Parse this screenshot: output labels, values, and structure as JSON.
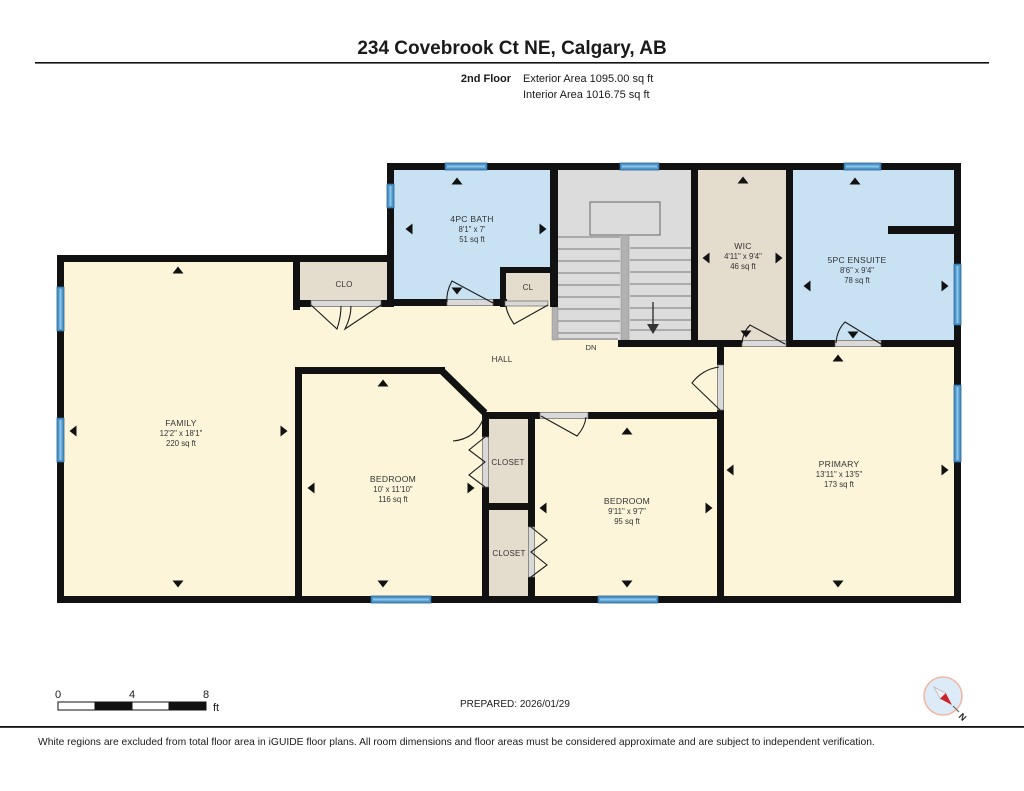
{
  "header": {
    "title": "234 Covebrook Ct NE, Calgary, AB",
    "floor_label": "2nd Floor",
    "exterior_area": "Exterior Area 1095.00 sq ft",
    "interior_area": "Interior Area 1016.75 sq ft"
  },
  "rooms": {
    "bath": {
      "name": "4PC BATH",
      "dims": "8'1\" x 7'",
      "area": "51 sq ft"
    },
    "wic": {
      "name": "WIC",
      "dims": "4'11\" x 9'4\"",
      "area": "46 sq ft"
    },
    "ensuite": {
      "name": "5PC ENSUITE",
      "dims": "8'6\" x 9'4\"",
      "area": "78 sq ft"
    },
    "family": {
      "name": "FAMILY",
      "dims": "12'2\" x 18'1\"",
      "area": "220 sq ft"
    },
    "bedroom1": {
      "name": "BEDROOM",
      "dims": "10' x 11'10\"",
      "area": "116 sq ft"
    },
    "bedroom2": {
      "name": "BEDROOM",
      "dims": "9'11\" x 9'7\"",
      "area": "95 sq ft"
    },
    "primary": {
      "name": "PRIMARY",
      "dims": "13'11\" x 13'5\"",
      "area": "173 sq ft"
    },
    "hall": {
      "name": "HALL"
    },
    "clo": {
      "name": "CLO"
    },
    "cl": {
      "name": "CL"
    },
    "closet_upper": {
      "name": "CLOSET"
    },
    "closet_lower": {
      "name": "CLOSET"
    },
    "stairs": {
      "down_label": "DN"
    }
  },
  "footer": {
    "scale_bar": {
      "tick_0": "0",
      "tick_4": "4",
      "tick_8": "8",
      "unit": "ft"
    },
    "prepared": "PREPARED: 2026/01/29",
    "compass_north": "N"
  },
  "disclaimer": "White regions are excluded from total floor area in iGUIDE floor plans. All room dimensions and floor areas must be considered approximate and are subject to independent verification.",
  "colors": {
    "wall": "#111111",
    "room_floor": "#fcf5da",
    "wet_room": "#c8e2f3",
    "closet": "#e4dccd",
    "stairs": "#dcdcdc",
    "window": "#4c97cc",
    "compass_north_color": "#cc2127"
  }
}
